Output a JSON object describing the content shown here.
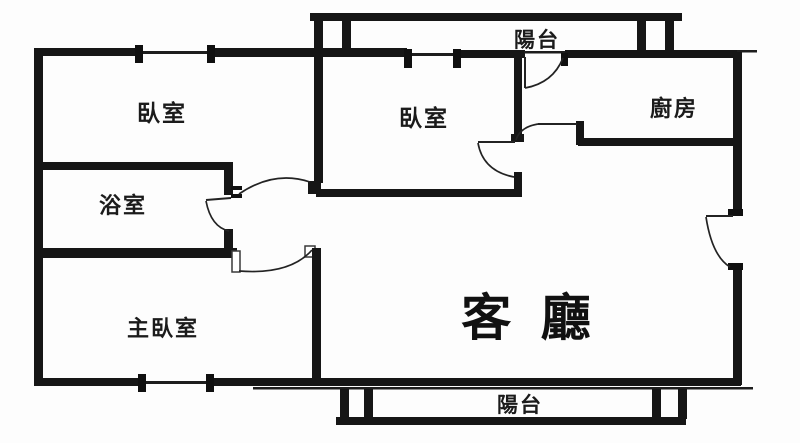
{
  "floor_plan": {
    "background_color": "#fdfdfd",
    "wall_color": "#161616",
    "rooms": [
      {
        "id": "balcony-top",
        "label": "陽台"
      },
      {
        "id": "bedroom-top-left",
        "label": "臥室"
      },
      {
        "id": "bedroom-middle",
        "label": "臥室"
      },
      {
        "id": "kitchen",
        "label": "廚房"
      },
      {
        "id": "bathroom",
        "label": "浴室"
      },
      {
        "id": "master-bedroom",
        "label": "主臥室"
      },
      {
        "id": "living-room",
        "label": "客 廳"
      },
      {
        "id": "balcony-bottom",
        "label": "陽台"
      }
    ]
  }
}
